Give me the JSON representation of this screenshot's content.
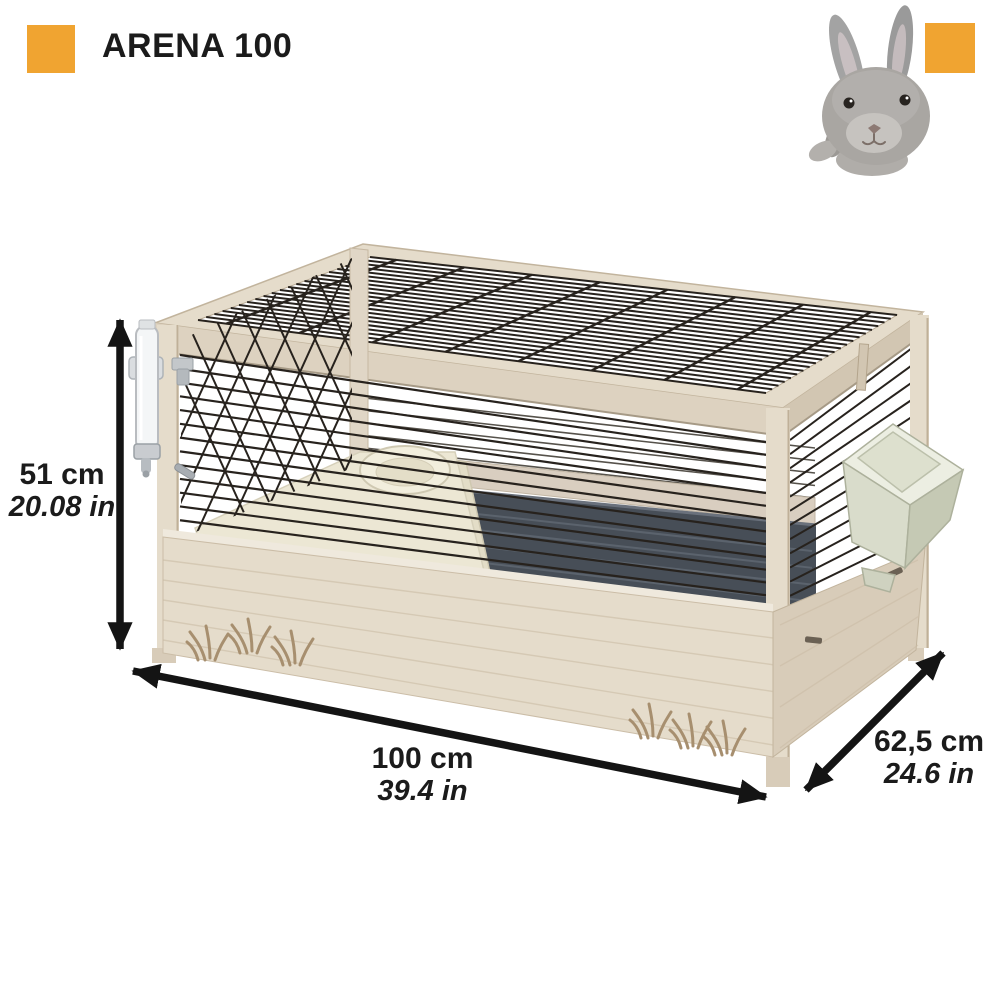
{
  "header": {
    "title": "ARENA 100"
  },
  "dimensions": {
    "height": {
      "cm": "51 cm",
      "in": "20.08 in"
    },
    "width": {
      "cm": "100 cm",
      "in": "39.4 in"
    },
    "depth": {
      "cm": "62,5 cm",
      "in": "24.6 in"
    }
  },
  "icons": {
    "brand_square_left": "orange-square",
    "brand_square_right": "orange-square",
    "animal_photo": "grey-rabbit",
    "product_illustration": "wooden-rabbit-cage-with-wire-mesh"
  },
  "colors": {
    "accent": "#F0A431",
    "text": "#1B1B1B",
    "bg": "#FFFFFF",
    "mesh": "#27221D",
    "wood": "#E5DCCB",
    "wood_shade": "#D8CCB9",
    "wood_dark": "#C9BAA3",
    "tray": "#474E57",
    "platform": "#ECE7D4",
    "feeder": "#DDE0CE",
    "rabbit_grey": "#A9A6A2",
    "arrow": "#141414"
  }
}
